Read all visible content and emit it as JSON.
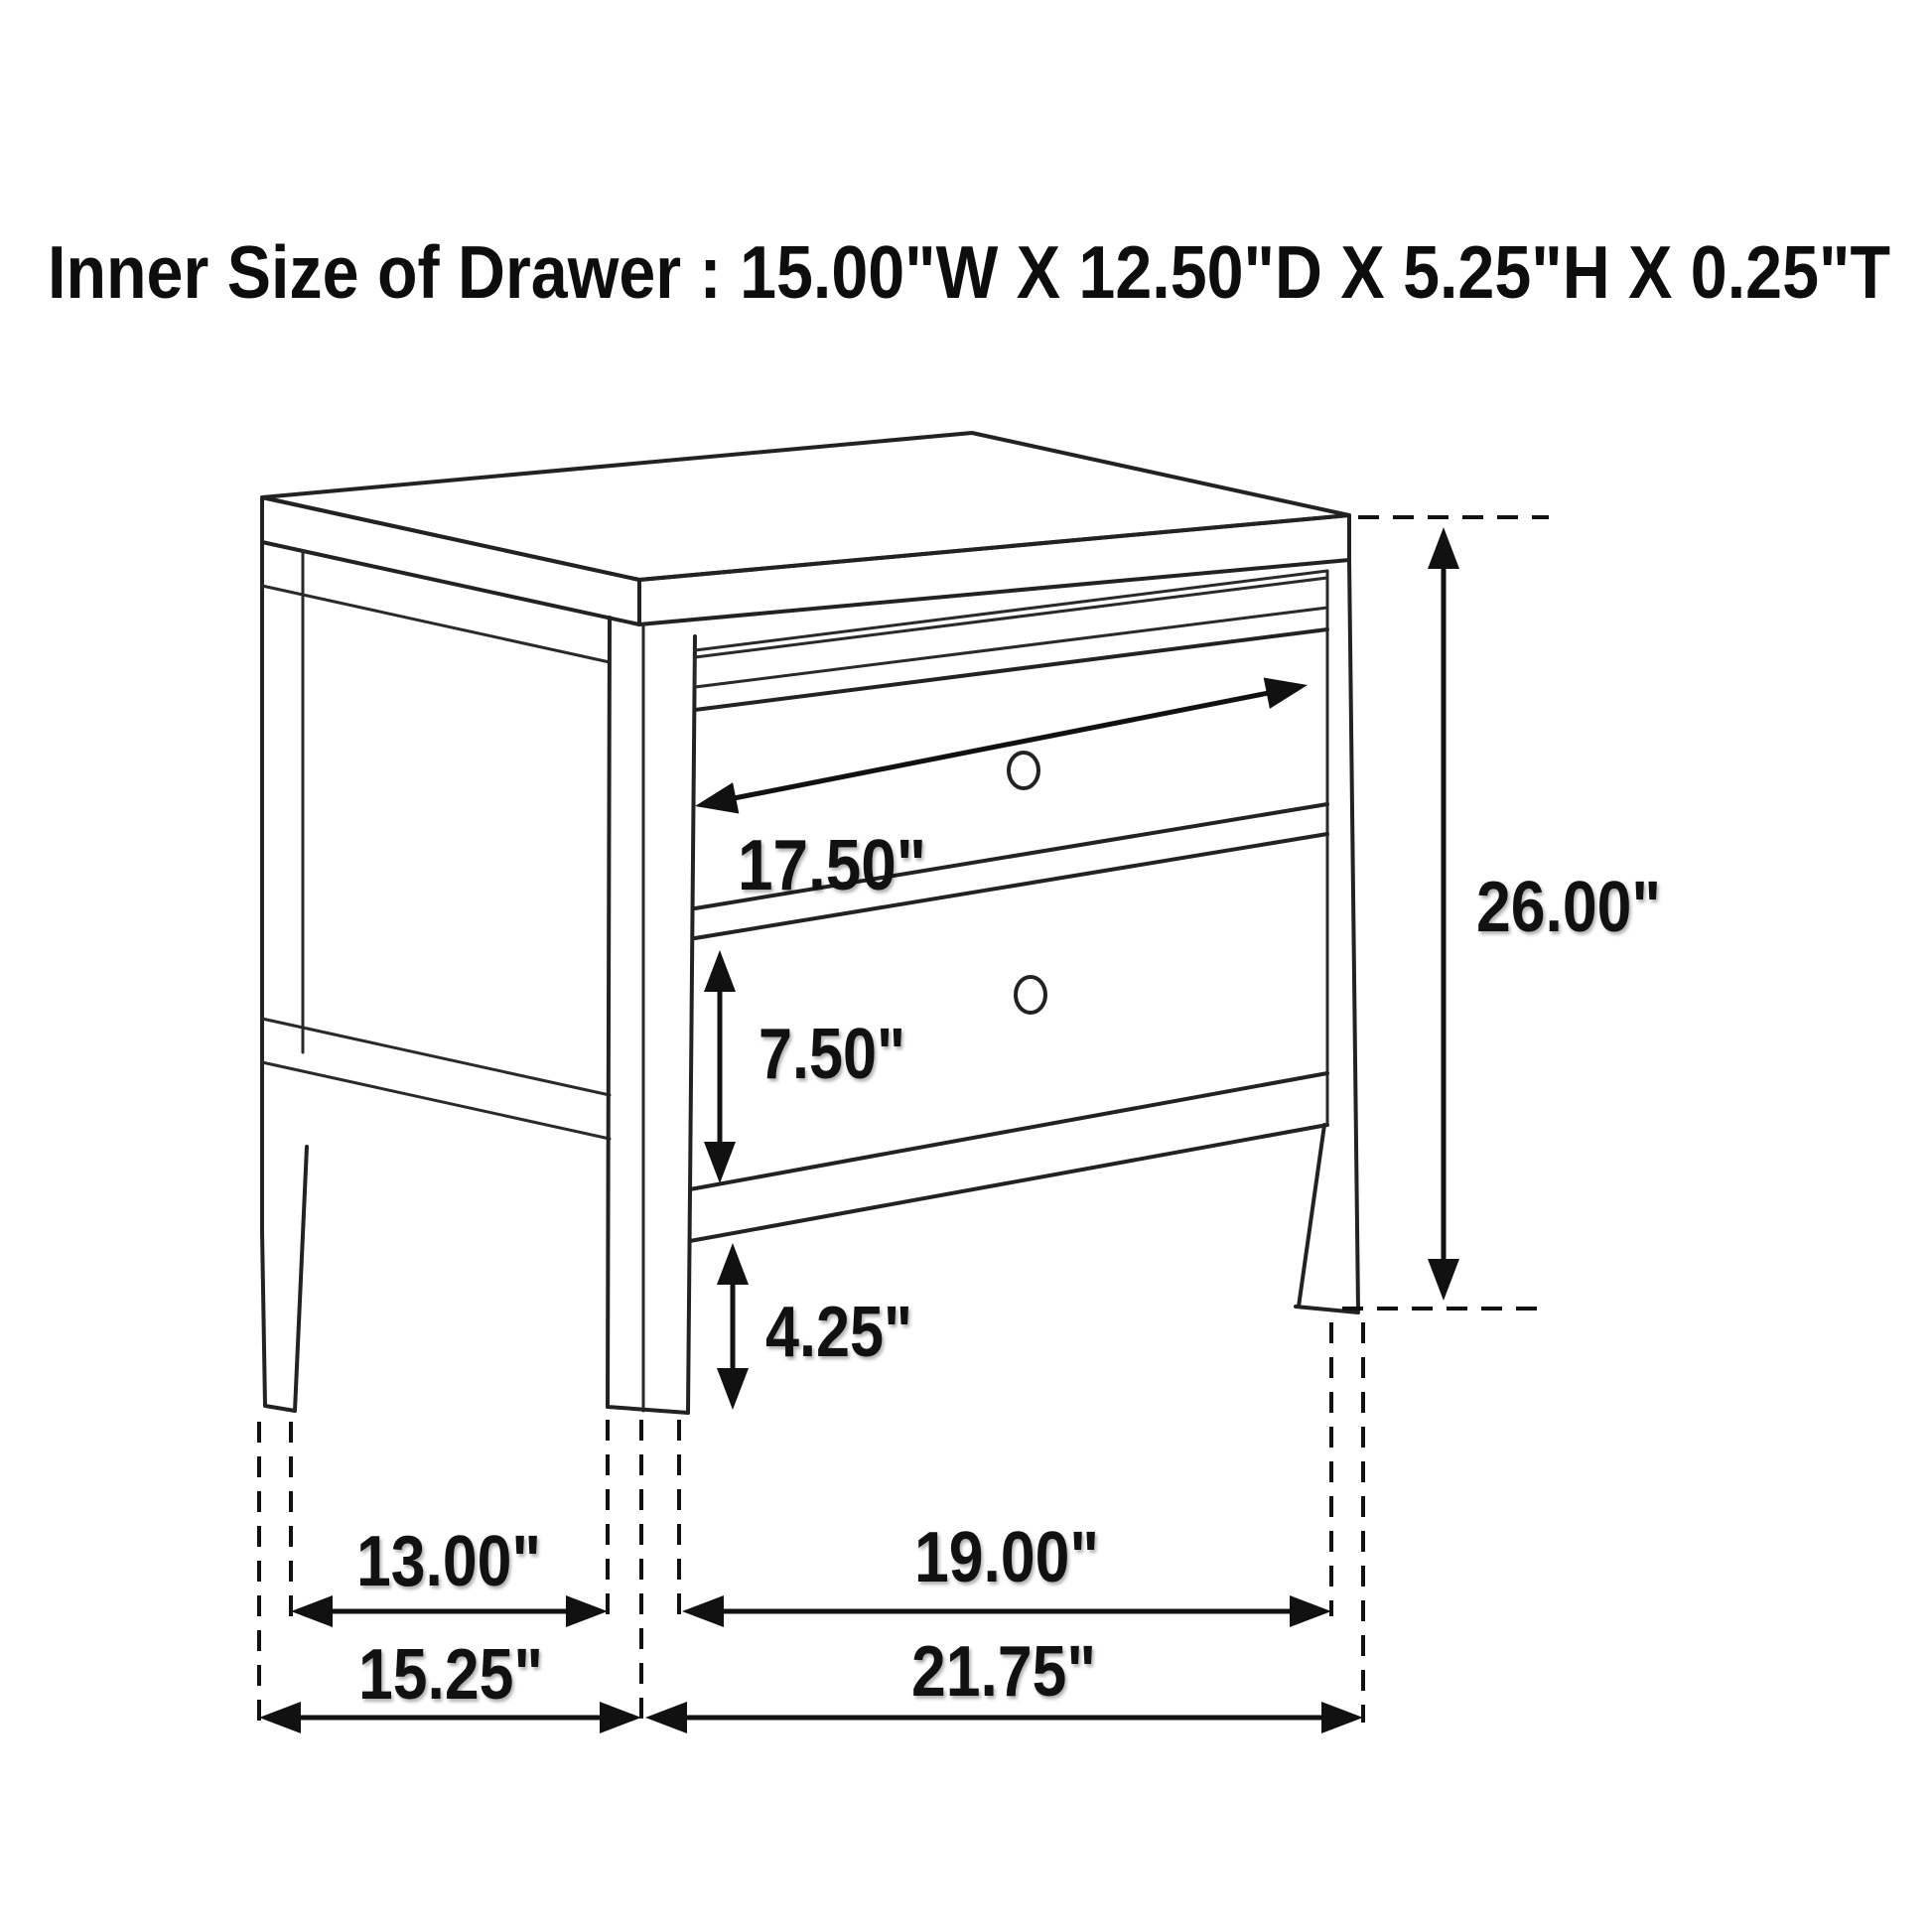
{
  "title": "Inner Size of Drawer : 15.00\"W X 12.50\"D X 5.25\"H X 0.25\"T",
  "inner_drawer_size": {
    "width": "15.00\"W",
    "depth": "12.50\"D",
    "height": "5.25\"H",
    "thickness": "0.25\"T"
  },
  "drawing": {
    "subject": "two-drawer nightstand dimension diagram",
    "dimensions": {
      "drawer_opening_width": "17.50\"",
      "overall_height": "26.00\"",
      "lower_drawer_height": "7.50\"",
      "floor_clearance": "4.25\"",
      "side_leg_spacing": "13.00\"",
      "overall_depth": "15.25\"",
      "front_leg_spacing": "19.00\"",
      "overall_width": "21.75\""
    }
  },
  "colors": {
    "background": "#ffffff",
    "line": "#222222",
    "text": "#111111",
    "hatch": "#777777"
  }
}
